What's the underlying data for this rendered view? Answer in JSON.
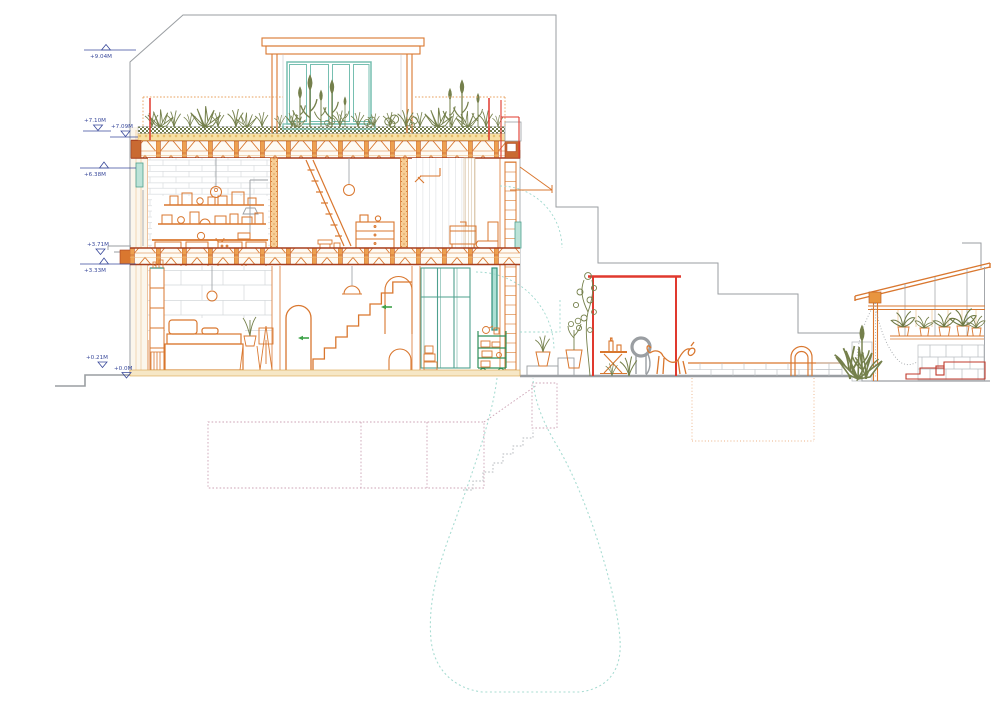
{
  "drawing": {
    "type": "architectural-cross-section",
    "levels": [
      {
        "label": "+9.04M"
      },
      {
        "label": "+7.10M"
      },
      {
        "label": "+7.09M"
      },
      {
        "label": "+6.38M"
      },
      {
        "label": "+3.71M"
      },
      {
        "label": "+3.33M"
      },
      {
        "label": "+0.21M"
      },
      {
        "label": "+0.0M"
      }
    ],
    "palette": {
      "line_orange": "#D9772F",
      "structure_red_brown": "#A63E1E",
      "accent_red": "#E0392E",
      "window_teal": "#76BFB1",
      "glass_green": "#4EA08E",
      "trolley_green": "#2F8F5B",
      "plant_olive": "#75804C",
      "annotation_navy": "#3A4A9B",
      "line_grey": "#9A9EA2",
      "dash_teal": "#9FD8CE",
      "dash_pink": "#CDA3B5"
    }
  }
}
